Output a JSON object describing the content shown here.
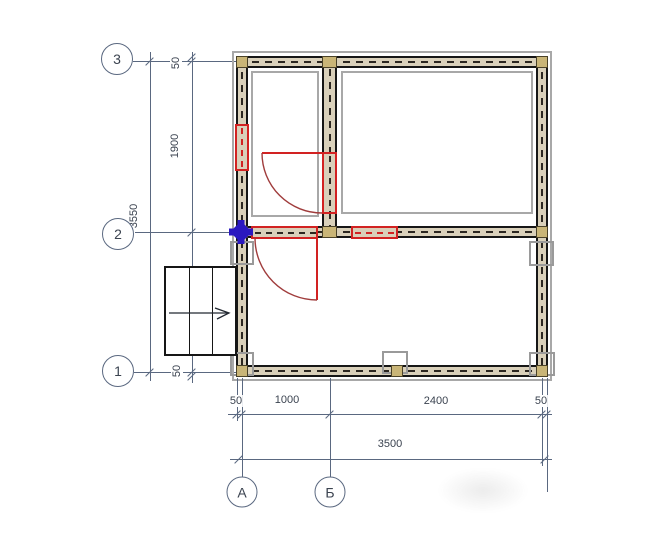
{
  "plan": {
    "row_axes": [
      {
        "label": "3"
      },
      {
        "label": "2"
      },
      {
        "label": "1"
      }
    ],
    "col_axes": [
      {
        "label": "А"
      },
      {
        "label": "Б"
      }
    ],
    "v_chain": [
      {
        "label": "50"
      },
      {
        "label": "1900"
      },
      {
        "label": "1550"
      },
      {
        "label": "50"
      }
    ],
    "v_overall": "3550",
    "h_chain": [
      {
        "label": "50"
      },
      {
        "label": "1000"
      },
      {
        "label": "2400"
      },
      {
        "label": "50"
      }
    ],
    "h_overall": "3500"
  },
  "colors": {
    "line": "#5a6880",
    "text": "#3b4350",
    "wall_fill": "#d9d0ba",
    "dash": "#2b2620",
    "log_fill": "#c9b577",
    "outline_gray": "#a8a8a8",
    "post_gray": "#9a9a9a",
    "opening_red": "#d22222",
    "door_leaf_red": "#d22222",
    "door_arc_red": "#a03c3c",
    "marker_blue": "#2a18c0"
  }
}
